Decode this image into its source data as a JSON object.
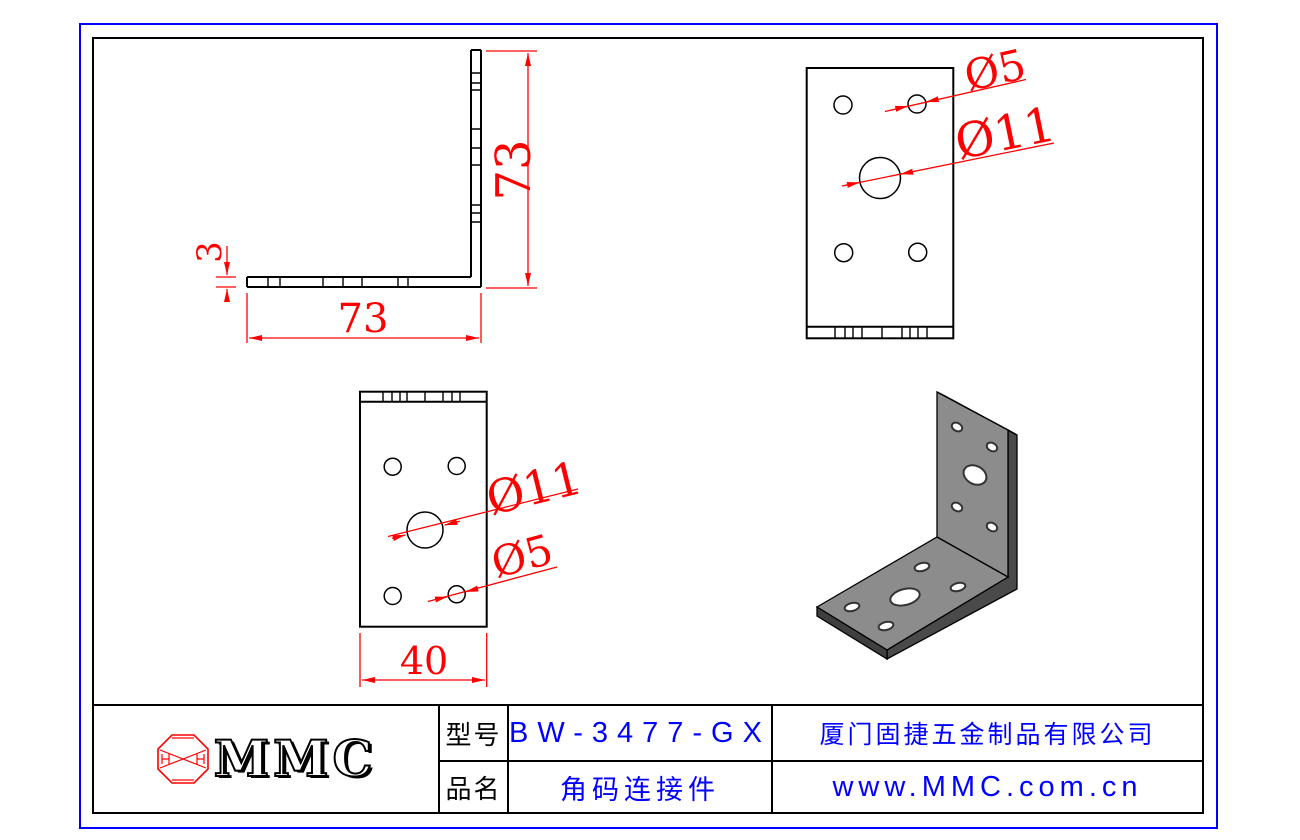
{
  "drawing": {
    "side_view": {
      "dim_height": "73",
      "dim_width": "73",
      "dim_thickness": "3"
    },
    "top_view": {
      "label_small_hole": "Ø5",
      "label_large_hole": "Ø11"
    },
    "front_view": {
      "label_large_hole": "Ø11",
      "label_small_hole": "Ø5",
      "dim_width": "40"
    }
  },
  "title_block": {
    "logo_text": "MMC",
    "model_label": "型号",
    "model_value": "BW-3477-GX",
    "product_label": "品名",
    "product_value": "角码连接件",
    "company": "厦门固捷五金制品有限公司",
    "website": "www.MMC.com.cn"
  },
  "colors": {
    "dimension_red": "#ff0000",
    "value_blue": "#0000ff",
    "line_black": "#000000",
    "outer_border_blue": "#0000ff",
    "bracket_gray": "#8c8c8c"
  }
}
